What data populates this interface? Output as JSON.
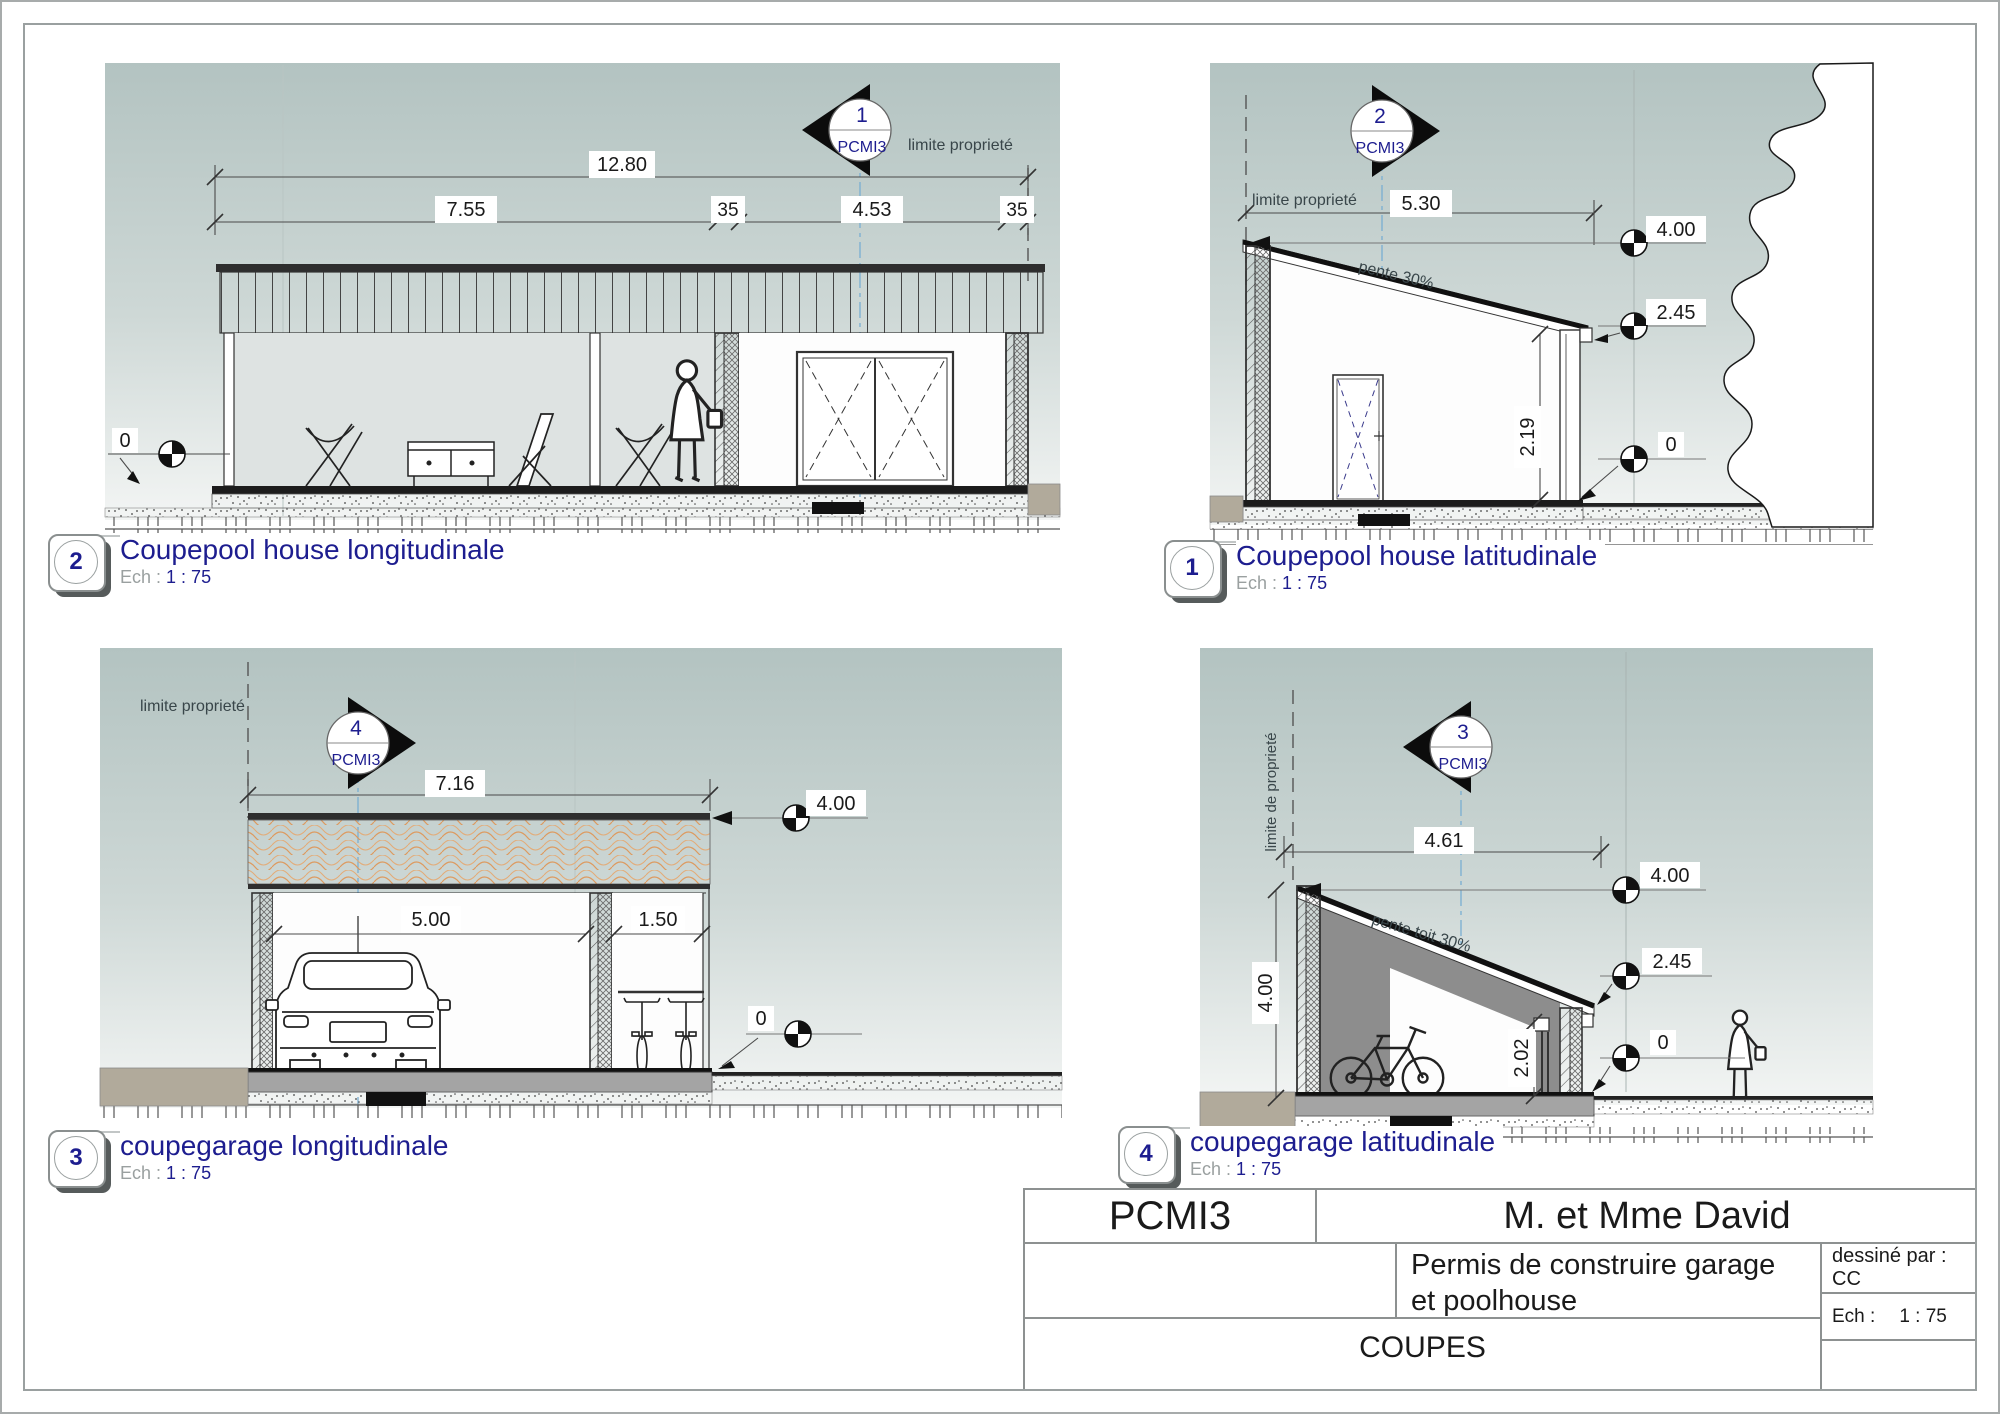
{
  "colors": {
    "accent_navy": "#1d1d8f",
    "sky_top": "#b3c3c1",
    "sky_bottom": "#f3f5f4",
    "tile_orange": "#dd9a5f",
    "slab_gray": "#a4a4a4",
    "wall_gray": "#8d8d8d",
    "terrain_tan": "#b1aa9b",
    "section_line_blue": "#79aed2"
  },
  "sections": {
    "pool_long": {
      "bubble_number": "2",
      "title": "Coupepool house longitudinale",
      "scale_prefix": "Ech :",
      "scale_value": "1 : 75",
      "marker_number": "1",
      "marker_code": "PCMI3",
      "limite": "limite proprieté",
      "dims": {
        "total": "12.80",
        "left": "7.55",
        "wall1": "35",
        "mid": "4.53",
        "wall2": "35"
      },
      "levels": {
        "zero": "0"
      }
    },
    "pool_lat": {
      "bubble_number": "1",
      "title": "Coupepool house latitudinale",
      "scale_prefix": "Ech :",
      "scale_value": "1 : 75",
      "marker_number": "2",
      "marker_code": "PCMI3",
      "limite": "limite proprieté",
      "pente": "pente 30%",
      "dims": {
        "width": "5.30",
        "wall_height": "2.19"
      },
      "levels": {
        "top": "4.00",
        "eave": "2.45",
        "zero": "0"
      }
    },
    "garage_long": {
      "bubble_number": "3",
      "title": "coupegarage longitudinale",
      "scale_prefix": "Ech :",
      "scale_value": "1 : 75",
      "marker_number": "4",
      "marker_code": "PCMI3",
      "limite": "limite proprieté",
      "dims": {
        "total": "7.16",
        "bay": "5.00",
        "store": "1.50"
      },
      "levels": {
        "top": "4.00",
        "zero": "0"
      }
    },
    "garage_lat": {
      "bubble_number": "4",
      "title": "coupegarage latitudinale",
      "scale_prefix": "Ech :",
      "scale_value": "1 : 75",
      "marker_number": "3",
      "marker_code": "PCMI3",
      "limite": "limite de proprieté",
      "pente": "pente toit 30%",
      "dims": {
        "width": "4.61",
        "wall_height": "4.00",
        "door_height": "2.02"
      },
      "levels": {
        "top": "4.00",
        "eave": "2.45",
        "zero": "0"
      }
    }
  },
  "title_block": {
    "code": "PCMI3",
    "client": "M. et Mme David",
    "project_line1": "Permis de construire garage",
    "project_line2": "et poolhouse",
    "drawn_by": "dessiné par : CC",
    "scale_prefix": "Ech :",
    "scale_value": "1 : 75",
    "sheet_name": "COUPES"
  }
}
